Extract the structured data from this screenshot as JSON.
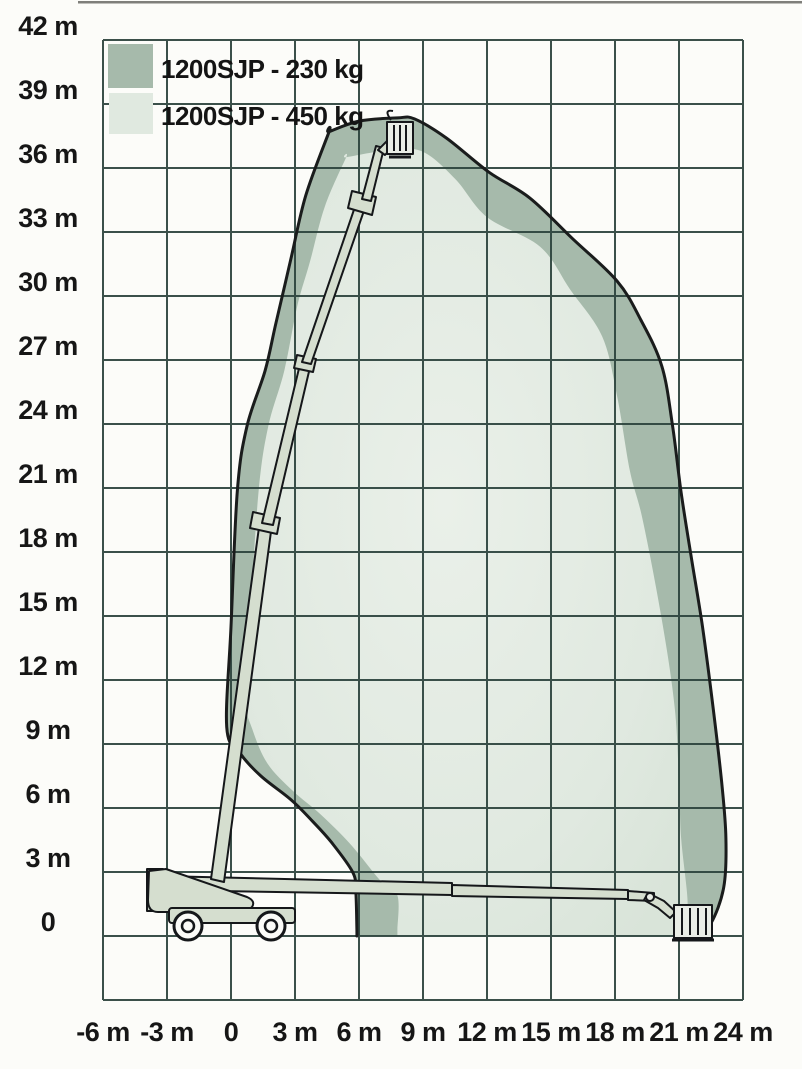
{
  "page": {
    "kind": "working-envelope-diagram",
    "model": "1200SJP"
  },
  "legend": {
    "items": [
      {
        "label": "1200SJP - 230 kg",
        "capacity_kg": 230,
        "color": "#a6baab"
      },
      {
        "label": "1200SJP - 450 kg",
        "capacity_kg": 450,
        "color": "#e0e9e0"
      }
    ]
  },
  "colors": {
    "grid": "#2b423c",
    "background": "#fcfcf9",
    "label": "#161616",
    "envelope_outline": "#1a1c1c",
    "machine_fill": "#d5decf",
    "machine_light_fill": "#e9ede6",
    "machine_stroke": "#15171a"
  },
  "chart_data": {
    "type": "area",
    "title": "",
    "xlabel": "",
    "ylabel": "",
    "xlim": [
      -6,
      24
    ],
    "ylim": [
      -3,
      42
    ],
    "grid": true,
    "grid_step": 3,
    "legend_position": "top-left",
    "units": "m",
    "x_ticks": [
      {
        "v": -6,
        "label": "-6 m"
      },
      {
        "v": -3,
        "label": "-3 m"
      },
      {
        "v": 0,
        "label": "0"
      },
      {
        "v": 3,
        "label": "3 m"
      },
      {
        "v": 6,
        "label": "6 m"
      },
      {
        "v": 9,
        "label": "9 m"
      },
      {
        "v": 12,
        "label": "12 m"
      },
      {
        "v": 15,
        "label": "15 m"
      },
      {
        "v": 18,
        "label": "18 m"
      },
      {
        "v": 21,
        "label": "21 m"
      },
      {
        "v": 24,
        "label": "24 m"
      }
    ],
    "y_ticks": [
      {
        "v": 42,
        "label": "42 m"
      },
      {
        "v": 39,
        "label": "39 m"
      },
      {
        "v": 36,
        "label": "36 m"
      },
      {
        "v": 33,
        "label": "33 m"
      },
      {
        "v": 30,
        "label": "30 m"
      },
      {
        "v": 27,
        "label": "27 m"
      },
      {
        "v": 24,
        "label": "24 m"
      },
      {
        "v": 21,
        "label": "21 m"
      },
      {
        "v": 18,
        "label": "18 m"
      },
      {
        "v": 15,
        "label": "15 m"
      },
      {
        "v": 12,
        "label": "12 m"
      },
      {
        "v": 9,
        "label": "9 m"
      },
      {
        "v": 6,
        "label": "6 m"
      },
      {
        "v": 3,
        "label": "3 m"
      },
      {
        "v": 0,
        "label": "0"
      }
    ],
    "series": [
      {
        "name": "1200SJP - 230 kg",
        "capacity_kg": 230,
        "color": "#a6baab",
        "outlined": true,
        "points": [
          [
            5.9,
            0
          ],
          [
            5.9,
            0.3
          ],
          [
            5.85,
            2.1
          ],
          [
            5.7,
            3.0
          ],
          [
            4.7,
            4.4
          ],
          [
            3.8,
            5.4
          ],
          [
            2.8,
            6.4
          ],
          [
            1.4,
            7.5
          ],
          [
            0.4,
            8.6
          ],
          [
            -0.2,
            9.8
          ],
          [
            0.0,
            14.5
          ],
          [
            0.3,
            20.9
          ],
          [
            0.75,
            23.9
          ],
          [
            1.6,
            26.5
          ],
          [
            2.1,
            28.7
          ],
          [
            2.8,
            31.7
          ],
          [
            3.5,
            34.7
          ],
          [
            4.6,
            37.7
          ],
          [
            4.6,
            37.7
          ],
          [
            6.0,
            38.2
          ],
          [
            7.8,
            38.35
          ],
          [
            8.6,
            38.3
          ],
          [
            10.1,
            37.4
          ],
          [
            12.1,
            35.8
          ],
          [
            14.0,
            34.6
          ],
          [
            16.0,
            32.7
          ],
          [
            18.1,
            30.7
          ],
          [
            19.2,
            28.9
          ],
          [
            20.2,
            26.7
          ],
          [
            20.7,
            23.9
          ],
          [
            21.1,
            20.8
          ],
          [
            21.6,
            17.6
          ],
          [
            22.1,
            14.5
          ],
          [
            22.6,
            10.7
          ],
          [
            23.0,
            7.2
          ],
          [
            23.2,
            4.6
          ],
          [
            23.1,
            2.3
          ],
          [
            22.5,
            0.6
          ],
          [
            21.8,
            0
          ]
        ]
      },
      {
        "name": "1200SJP - 450 kg",
        "capacity_kg": 450,
        "color": "#e0e9e0",
        "outlined": false,
        "points": [
          [
            7.8,
            0
          ],
          [
            7.8,
            0.3
          ],
          [
            7.8,
            1.9
          ],
          [
            7.0,
            2.6
          ],
          [
            5.6,
            4.3
          ],
          [
            4.2,
            5.7
          ],
          [
            2.9,
            6.8
          ],
          [
            1.7,
            8.1
          ],
          [
            1.0,
            9.7
          ],
          [
            0.7,
            11.1
          ],
          [
            0.9,
            15.0
          ],
          [
            1.3,
            20.9
          ],
          [
            1.75,
            23.9
          ],
          [
            2.5,
            26.5
          ],
          [
            3.1,
            29.5
          ],
          [
            3.7,
            31.6
          ],
          [
            4.4,
            34.2
          ],
          [
            5.4,
            36.5
          ],
          [
            5.4,
            36.5
          ],
          [
            7.2,
            36.8
          ],
          [
            8.9,
            36.8
          ],
          [
            10.5,
            35.5
          ],
          [
            12.0,
            33.7
          ],
          [
            14.5,
            32.3
          ],
          [
            15.9,
            30.3
          ],
          [
            17.4,
            28.1
          ],
          [
            18.1,
            25.3
          ],
          [
            18.7,
            21.8
          ],
          [
            19.3,
            19.5
          ],
          [
            20.2,
            14.8
          ],
          [
            20.8,
            10.7
          ],
          [
            21.0,
            7.2
          ],
          [
            21.1,
            4.6
          ],
          [
            21.4,
            1.7
          ],
          [
            21.3,
            0.5
          ],
          [
            21.0,
            0
          ]
        ]
      }
    ]
  }
}
